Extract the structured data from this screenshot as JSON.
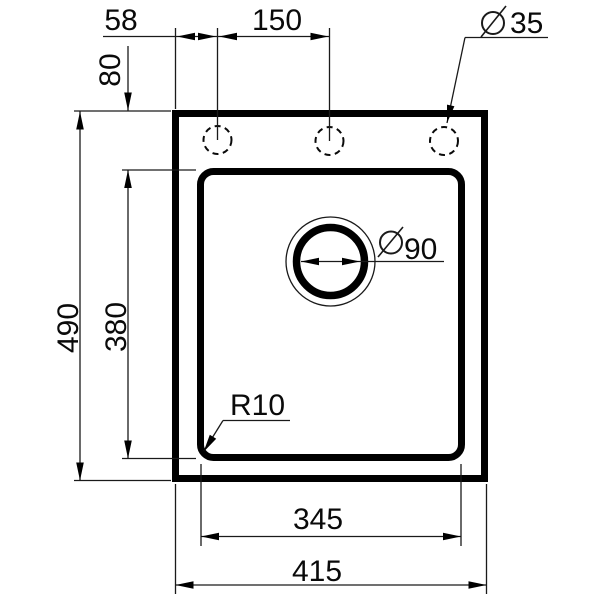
{
  "drawing": {
    "type": "sink-top-view-dimension-drawing",
    "colors": {
      "outline": "#000000",
      "thin_line": "#1a1a1a",
      "background": "#ffffff"
    },
    "dims": {
      "hole_offset": "58",
      "hole_spacing": "150",
      "rim_to_bowl_top": "80",
      "overall_depth": "490",
      "bowl_depth": "380",
      "bowl_width": "345",
      "overall_width": "415",
      "corner_radius": "R10",
      "diameter_symbol": "⌀",
      "faucet_hole_diameter": "35",
      "drain_diameter": "90"
    }
  }
}
